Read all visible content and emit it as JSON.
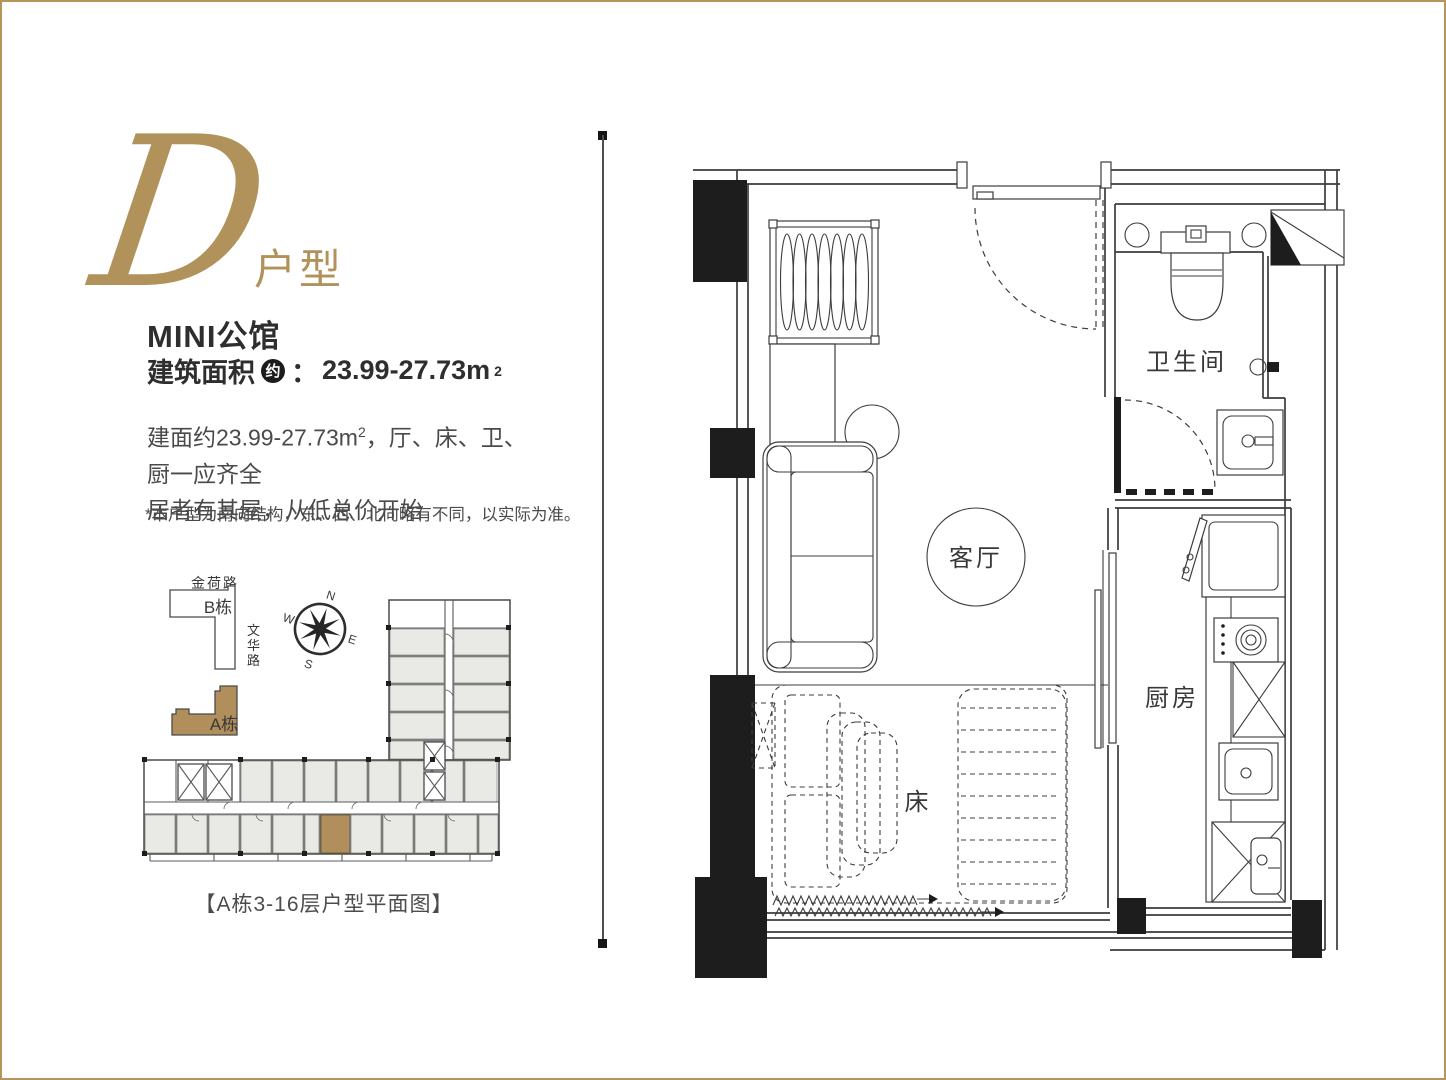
{
  "page": {
    "border_color": "#b5955c",
    "background": "#ffffff"
  },
  "header": {
    "logo_letter": "D",
    "logo_suffix": "户型",
    "title": "MINI公馆",
    "area_prefix": "建筑面积",
    "area_circle": "约",
    "area_colon": "：",
    "area_value": "23.99-27.73m",
    "area_sup": "2"
  },
  "description": {
    "line1_pre": "建面约23.99-27.73m",
    "line1_sup": "2",
    "line1_post": "，厅、床、卫、厨一应齐全",
    "line2": "居者有其屋，从低总价开始",
    "note": "*本户型为南向结构，东、西、北向略有不同，以实际为准。"
  },
  "site_plan": {
    "road_top": "金荷路",
    "building_b_label": "B栋",
    "road_right_chars": [
      "文",
      "华",
      "路"
    ],
    "building_a_label": "A栋",
    "compass": {
      "n": "N",
      "e": "E",
      "s": "S",
      "w": "W"
    },
    "caption": "【A栋3-16层户型平面图】",
    "highlight_color": "#b08f5c",
    "unit_fill": "#e9e9e6"
  },
  "floor_plan": {
    "bathroom_label": "卫生间",
    "living_label": "客厅",
    "kitchen_label": "厨房",
    "bed_label": "床",
    "accent_gold": "#b1925a"
  }
}
